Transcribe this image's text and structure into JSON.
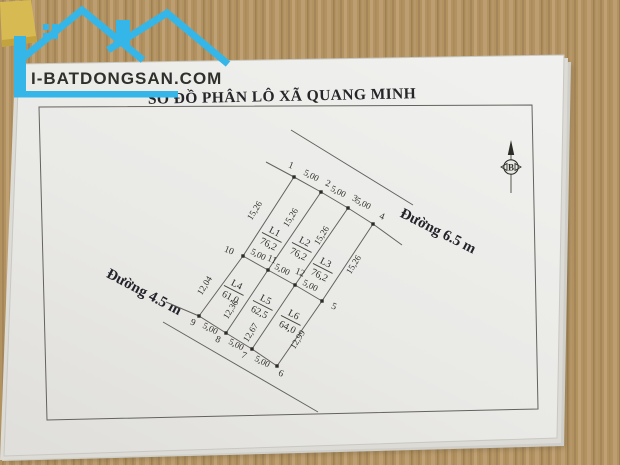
{
  "brand": {
    "text": "I-BATDONGSAN.COM",
    "color": "#35b6e8"
  },
  "title": "SƠ ĐỒ PHÂN LÔ XÃ QUANG MINH",
  "compass": {
    "north_label": "B"
  },
  "roads": {
    "top": "Đường 6.5 m",
    "left": "Đường 4.5 m"
  },
  "lots": [
    {
      "id": "L1",
      "area": "76,2"
    },
    {
      "id": "L2",
      "area": "76,2"
    },
    {
      "id": "L3",
      "area": "76,2"
    },
    {
      "id": "L4",
      "area": "61,0"
    },
    {
      "id": "L5",
      "area": "62,5"
    },
    {
      "id": "L6",
      "area": "64,0"
    }
  ],
  "points": [
    "1",
    "2",
    "3",
    "4",
    "5",
    "6",
    "7",
    "8",
    "9",
    "10",
    "11",
    "12"
  ],
  "segments": {
    "top": [
      "5,00",
      "5,00",
      "5,00"
    ],
    "middle": [
      "5,00",
      "5,00",
      "5,00"
    ],
    "bottom": [
      "5,00",
      "5,00",
      "5,00"
    ]
  },
  "depths": {
    "row1": [
      "15,26",
      "15,26",
      "15,26",
      "15,26"
    ],
    "row2": [
      "12,04",
      "12,36",
      "12,67",
      "12,99"
    ]
  }
}
